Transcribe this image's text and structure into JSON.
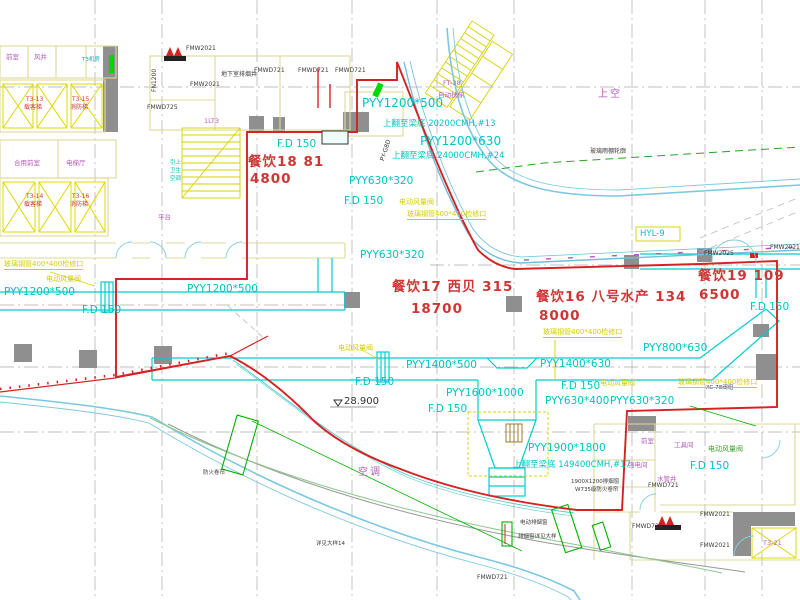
{
  "drawing": {
    "type": "HVAC ventilation floor plan (CAD)",
    "elevation_mark": "28.900"
  },
  "colors": {
    "duct_cyan": "#00c4c4",
    "boundary_red": "#d62222",
    "annotation_yellow": "#d4cc00",
    "wall_yellow": "#ded898",
    "room_magenta": "#b55cb5",
    "column_gray": "#8f8f8f",
    "green": "#00b000",
    "curtainwall_blue": "#7cc8e0"
  },
  "labels": [
    {
      "name": "duct-label-pyy1200x500-top",
      "text": "PYY1200*500",
      "x": 362,
      "y": 97,
      "cls": "cyan-lg"
    },
    {
      "name": "note-20200cmh",
      "text": "上翻至梁底 20200CMH,#13",
      "x": 383,
      "y": 120,
      "cls": "cyan-sm"
    },
    {
      "name": "duct-label-pyy1200x630",
      "text": "PYY1200*630",
      "x": 420,
      "y": 135,
      "cls": "cyan-lg"
    },
    {
      "name": "note-24000cmh",
      "text": "上翻至梁底 24000CMH,#24",
      "x": 392,
      "y": 152,
      "cls": "cyan-sm"
    },
    {
      "name": "duct-label-pyy630x320-a",
      "text": "PYY630*320",
      "x": 349,
      "y": 176,
      "cls": "cyan"
    },
    {
      "name": "fd150-a",
      "text": "F.D 150",
      "x": 344,
      "y": 196,
      "cls": "cyan"
    },
    {
      "name": "fd150-b",
      "text": "F.D 150",
      "x": 277,
      "y": 139,
      "cls": "cyan"
    },
    {
      "name": "duct-label-pyy1200x500-left",
      "text": "PYY1200*500",
      "x": 4,
      "y": 287,
      "cls": "cyan"
    },
    {
      "name": "duct-label-pyy1200x500-mid",
      "text": "PYY1200*500",
      "x": 187,
      "y": 284,
      "cls": "cyan"
    },
    {
      "name": "fd150-c",
      "text": "F.D 150",
      "x": 82,
      "y": 305,
      "cls": "cyan"
    },
    {
      "name": "duct-label-pyy630x320-b",
      "text": "PYY630*320",
      "x": 360,
      "y": 250,
      "cls": "cyan"
    },
    {
      "name": "area-canyin18",
      "text": "餐饮18  81",
      "x": 248,
      "y": 156,
      "cls": "red-lg"
    },
    {
      "name": "area-canyin18-flow",
      "text": "4800",
      "x": 250,
      "y": 173,
      "cls": "red-lg"
    },
    {
      "name": "area-canyin17",
      "text": "餐饮17  西贝  315",
      "x": 392,
      "y": 281,
      "cls": "red-lg"
    },
    {
      "name": "area-canyin17-flow",
      "text": "18700",
      "x": 411,
      "y": 303,
      "cls": "red-lg"
    },
    {
      "name": "area-canyin16",
      "text": "餐饮16  八号水产 134",
      "x": 536,
      "y": 291,
      "cls": "red-lg"
    },
    {
      "name": "area-canyin16-flow",
      "text": "8000",
      "x": 539,
      "y": 310,
      "cls": "red-lg"
    },
    {
      "name": "area-canyin19",
      "text": "餐饮19  109",
      "x": 698,
      "y": 270,
      "cls": "red-lg"
    },
    {
      "name": "area-canyin19-flow",
      "text": "6500",
      "x": 699,
      "y": 289,
      "cls": "red-lg"
    },
    {
      "name": "duct-label-pyy800x630",
      "text": "PYY800*630",
      "x": 643,
      "y": 343,
      "cls": "cyan"
    },
    {
      "name": "duct-label-pyy1400x630",
      "text": "PYY1400*630",
      "x": 540,
      "y": 359,
      "cls": "cyan"
    },
    {
      "name": "fd150-d",
      "text": "F.D 150",
      "x": 561,
      "y": 381,
      "cls": "cyan"
    },
    {
      "name": "duct-label-pyy630x400",
      "text": "PYY630*400",
      "x": 545,
      "y": 396,
      "cls": "cyan"
    },
    {
      "name": "duct-label-pyy1400x500",
      "text": "PYY1400*500",
      "x": 406,
      "y": 360,
      "cls": "cyan"
    },
    {
      "name": "duct-label-pyy1600x1000",
      "text": "PYY1600*1000",
      "x": 446,
      "y": 388,
      "cls": "cyan"
    },
    {
      "name": "fd150-e",
      "text": "F.D 150",
      "x": 428,
      "y": 404,
      "cls": "cyan"
    },
    {
      "name": "fd150-f",
      "text": "F.D 150",
      "x": 355,
      "y": 377,
      "cls": "cyan"
    },
    {
      "name": "duct-label-pyy1900x1800",
      "text": "PYY1900*1800",
      "x": 528,
      "y": 443,
      "cls": "cyan"
    },
    {
      "name": "note-149400cmh",
      "text": "上翻至梁底 149400CMH,#17",
      "x": 513,
      "y": 461,
      "cls": "cyan-sm"
    },
    {
      "name": "fd150-g",
      "text": "F.D 150",
      "x": 690,
      "y": 461,
      "cls": "cyan"
    },
    {
      "name": "duct-label-pyy630x320-c",
      "text": "PYY630*320",
      "x": 610,
      "y": 396,
      "cls": "cyan"
    },
    {
      "name": "fd150-h",
      "text": "F.D 150",
      "x": 750,
      "y": 302,
      "cls": "cyan"
    },
    {
      "name": "hyl-9",
      "text": "HYL-9",
      "x": 640,
      "y": 230,
      "cls": "cyan-sm"
    },
    {
      "name": "elevation-28900",
      "text": "28.900",
      "x": 344,
      "y": 397,
      "cls": "blk"
    },
    {
      "name": "note-canopy",
      "text": "玻璃雨棚轮廓",
      "x": 590,
      "y": 149,
      "cls": "blk-sm"
    },
    {
      "name": "note-basement-shaft",
      "text": "地下室排烟井",
      "x": 221,
      "y": 72,
      "cls": "blk-sm"
    },
    {
      "name": "fmwd721-a",
      "text": "FMWD721",
      "x": 254,
      "y": 68,
      "cls": "blk-sm"
    },
    {
      "name": "fmwd721-b",
      "text": "FMWD721",
      "x": 298,
      "y": 68,
      "cls": "blk-sm"
    },
    {
      "name": "fmwd721-c",
      "text": "FMWD721",
      "x": 335,
      "y": 68,
      "cls": "blk-sm"
    },
    {
      "name": "fmw2021-a",
      "text": "FMW2021",
      "x": 186,
      "y": 46,
      "cls": "blk-sm"
    },
    {
      "name": "fmw2021-b",
      "text": "FMW2021",
      "x": 190,
      "y": 82,
      "cls": "blk-sm"
    },
    {
      "name": "fmwd725",
      "text": "FMWD725",
      "x": 147,
      "y": 105,
      "cls": "blk-sm"
    },
    {
      "name": "fn1200",
      "text": "FN1200",
      "x": 152,
      "y": 92,
      "cls": "blk-sm",
      "rot": -90
    },
    {
      "name": "fmw2025",
      "text": "FMW2025",
      "x": 704,
      "y": 251,
      "cls": "blk-sm"
    },
    {
      "name": "fmw2021-r",
      "text": "FMW2021",
      "x": 770,
      "y": 245,
      "cls": "blk-sm"
    },
    {
      "name": "py-g8d",
      "text": "PY-G8D",
      "x": 380,
      "y": 160,
      "cls": "blk-sm",
      "rot": -72
    },
    {
      "name": "fmwd721-d",
      "text": "FMWD721",
      "x": 648,
      "y": 483,
      "cls": "blk-sm"
    },
    {
      "name": "fmwd721-e",
      "text": "FMWD721",
      "x": 632,
      "y": 524,
      "cls": "blk-sm"
    },
    {
      "name": "fmw2021-c",
      "text": "FMW2021",
      "x": 700,
      "y": 512,
      "cls": "blk-sm"
    },
    {
      "name": "fmw2021-d",
      "text": "FMW2021",
      "x": 700,
      "y": 543,
      "cls": "blk-sm"
    },
    {
      "name": "fmwd721-f",
      "text": "FMWD721",
      "x": 477,
      "y": 575,
      "cls": "blk-sm"
    },
    {
      "name": "note-smoke-window-size",
      "text": "1900X1200排烟窗",
      "x": 571,
      "y": 480,
      "cls": "blk-xs"
    },
    {
      "name": "note-fire-shutter",
      "text": "W735级防火卷帘",
      "x": 575,
      "y": 488,
      "cls": "blk-xs"
    },
    {
      "name": "note-smoke-window",
      "text": "电动排烟窗",
      "x": 520,
      "y": 521,
      "cls": "blk-xs"
    },
    {
      "name": "note-smoke-window-detail",
      "text": "排烟窗详见大样",
      "x": 518,
      "y": 535,
      "cls": "blk-xs"
    },
    {
      "name": "note-detail-14",
      "text": "详见大样14",
      "x": 316,
      "y": 542,
      "cls": "blk-xs"
    },
    {
      "name": "note-fire-shutter-b",
      "text": "防火卷帘",
      "x": 203,
      "y": 471,
      "cls": "blk-xs"
    },
    {
      "name": "note-xc78",
      "text": "XC-78阀组",
      "x": 706,
      "y": 386,
      "cls": "blk-xs"
    },
    {
      "name": "jiankou-a",
      "text": "玻璃钢管400*400检修口",
      "x": 4,
      "y": 261,
      "cls": "yel-u"
    },
    {
      "name": "fan-a",
      "text": "电动风量阀",
      "x": 46,
      "y": 276,
      "cls": "yel"
    },
    {
      "name": "fan-b",
      "text": "电动风量阀",
      "x": 399,
      "y": 199,
      "cls": "yel"
    },
    {
      "name": "jiankou-b",
      "text": "玻璃钢管400*400检修口",
      "x": 407,
      "y": 211,
      "cls": "yel-u"
    },
    {
      "name": "jiankou-c",
      "text": "玻璃钢管400*400检修口",
      "x": 543,
      "y": 329,
      "cls": "yel-u"
    },
    {
      "name": "fan-c",
      "text": "电动风量阀",
      "x": 338,
      "y": 345,
      "cls": "yel"
    },
    {
      "name": "fan-d",
      "text": "电动风量阀",
      "x": 600,
      "y": 380,
      "cls": "yel"
    },
    {
      "name": "jiankou-d",
      "text": "玻璃钢管400*400检修口",
      "x": 678,
      "y": 379,
      "cls": "yel-u"
    },
    {
      "name": "fan-e",
      "text": "电动风量阀",
      "x": 708,
      "y": 446,
      "cls": "grn"
    },
    {
      "name": "label-shangkong",
      "text": "上空",
      "x": 598,
      "y": 90,
      "cls": "mag-lg"
    },
    {
      "name": "label-kongtiao",
      "text": "空调",
      "x": 358,
      "y": 468,
      "cls": "mag-lg"
    },
    {
      "name": "lift-t313",
      "text": "T3-13",
      "x": 26,
      "y": 97,
      "cls": "red-xs"
    },
    {
      "name": "lift-t313-type",
      "text": "载客梯",
      "x": 24,
      "y": 105,
      "cls": "red-xs"
    },
    {
      "name": "lift-t315",
      "text": "T3-15",
      "x": 72,
      "y": 97,
      "cls": "red-xs"
    },
    {
      "name": "lift-t315-type",
      "text": "消防梯",
      "x": 70,
      "y": 105,
      "cls": "red-xs"
    },
    {
      "name": "lift-t314",
      "text": "T3-14",
      "x": 26,
      "y": 194,
      "cls": "red-xs"
    },
    {
      "name": "lift-t314-type",
      "text": "载客梯",
      "x": 24,
      "y": 202,
      "cls": "red-xs"
    },
    {
      "name": "lift-t316",
      "text": "T3-16",
      "x": 72,
      "y": 194,
      "cls": "red-xs"
    },
    {
      "name": "lift-t316-type",
      "text": "消防梯",
      "x": 70,
      "y": 202,
      "cls": "red-xs"
    },
    {
      "name": "stair-lt3",
      "text": "1LT3",
      "x": 204,
      "y": 118,
      "cls": "mag"
    },
    {
      "name": "label-pingtai",
      "text": "平台",
      "x": 158,
      "y": 214,
      "cls": "mag"
    },
    {
      "name": "riser-yinshang",
      "text": "引上",
      "x": 170,
      "y": 161,
      "cls": "cyan-xs"
    },
    {
      "name": "riser-weisheng",
      "text": "卫生",
      "x": 170,
      "y": 169,
      "cls": "cyan-xs"
    },
    {
      "name": "riser-kongtiao",
      "text": "空调",
      "x": 170,
      "y": 177,
      "cls": "cyan-xs"
    },
    {
      "name": "room-qianshi",
      "text": "前室",
      "x": 641,
      "y": 438,
      "cls": "mag"
    },
    {
      "name": "room-gongju",
      "text": "工具间",
      "x": 674,
      "y": 442,
      "cls": "mag"
    },
    {
      "name": "room-qiangdian",
      "text": "强电间",
      "x": 628,
      "y": 462,
      "cls": "mag"
    },
    {
      "name": "room-shuiguanjing",
      "text": "水管井",
      "x": 657,
      "y": 476,
      "cls": "mag"
    },
    {
      "name": "lift-t321",
      "text": "T3-21",
      "x": 763,
      "y": 540,
      "cls": "mag"
    },
    {
      "name": "room-heyong",
      "text": "合用前室",
      "x": 14,
      "y": 160,
      "cls": "mag"
    },
    {
      "name": "room-dianti-ting",
      "text": "电梯厅",
      "x": 66,
      "y": 160,
      "cls": "mag"
    },
    {
      "name": "room-qianshi-tl",
      "text": "前室",
      "x": 6,
      "y": 54,
      "cls": "mag"
    },
    {
      "name": "room-fengjing",
      "text": "风井",
      "x": 34,
      "y": 54,
      "cls": "mag"
    },
    {
      "name": "esc-ft38",
      "text": "FT-38",
      "x": 443,
      "y": 80,
      "cls": "mag"
    },
    {
      "name": "esc-label",
      "text": "自动扶梯",
      "x": 438,
      "y": 92,
      "cls": "mag"
    },
    {
      "name": "room-t3-jifang",
      "text": "T3机房",
      "x": 82,
      "y": 58,
      "cls": "cyan-xs"
    }
  ]
}
